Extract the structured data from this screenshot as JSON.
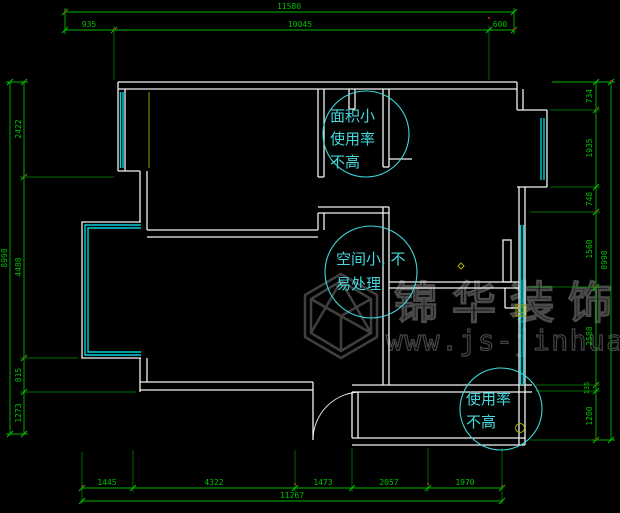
{
  "title": "apartment-floor-plan-cad",
  "colors": {
    "background": "#000000",
    "walls": "#f2f2f2",
    "windows": "#00d2dc",
    "dimensions": "#00b400",
    "annotation_text": "#46d8dc",
    "watermark": "#4a4a4a",
    "accent_yellow": "#b0b000",
    "tick_red": "#992222"
  },
  "dimensions": {
    "top": {
      "overall": "11580",
      "seg1": "935",
      "seg2": "10045",
      "seg3": "600"
    },
    "bottom": {
      "overall": "11267",
      "seg1": "1445",
      "seg2": "4322",
      "seg3": "1473",
      "seg4": "2057",
      "seg5": "1970"
    },
    "left": {
      "overall": "8998",
      "seg1": "2422",
      "seg2": "4488",
      "seg3": "815",
      "seg4": "1273"
    },
    "right": {
      "overall": "8998",
      "seg1": "734",
      "seg2": "1935",
      "seg3": "748",
      "seg4": "1560",
      "seg5": "2588",
      "seg6": "135",
      "seg7": "1200"
    }
  },
  "annotations": {
    "circle1": {
      "line1": "面积小",
      "line2": "使用率",
      "line3": "不高"
    },
    "circle2": {
      "line1": "空间小, 不",
      "line2": "易处理"
    },
    "circle3": {
      "line1": "使用率",
      "line2": "不高"
    }
  },
  "watermark": {
    "brand": "锦华装饰",
    "website": "www.js-jinhua.com"
  }
}
